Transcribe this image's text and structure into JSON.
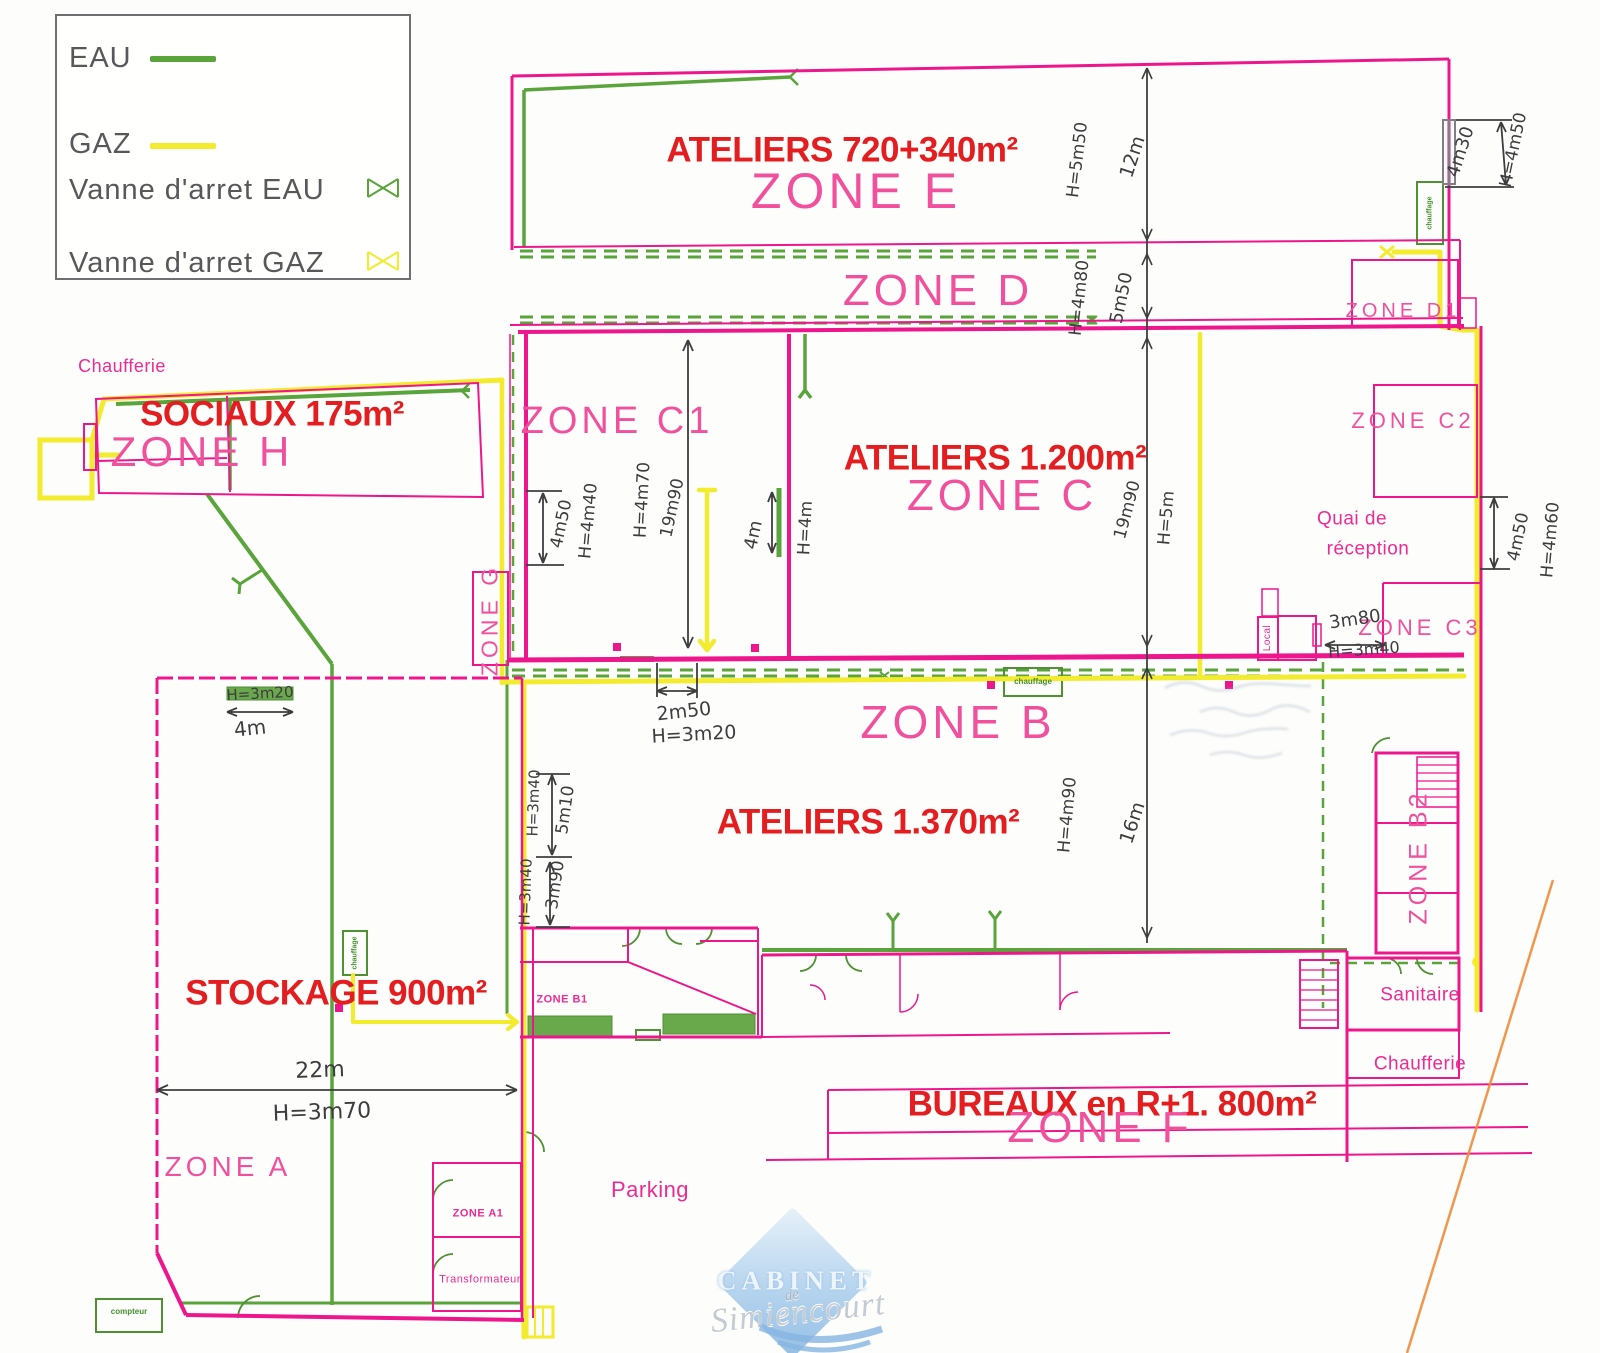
{
  "colors": {
    "wall_pink": "#ee168d",
    "zone_label_pink": "#f0509c",
    "red_area_label": "#e41d20",
    "water_green": "#5aa43c",
    "gas_yellow": "#f3eb2e",
    "dimension_ink": "#3d3d40",
    "boundary_orange": "#ef8b3a",
    "watermark_blue": "#a9cdec"
  },
  "legend": {
    "items": [
      {
        "label": "EAU",
        "symbol": "line",
        "color": "#5aa43c"
      },
      {
        "label": "GAZ",
        "symbol": "line",
        "color": "#f3eb2e"
      },
      {
        "label": "Vanne d'arret EAU",
        "symbol": "valve",
        "color": "#5aa43c"
      },
      {
        "label": "Vanne d'arret GAZ",
        "symbol": "valve",
        "color": "#f3eb2e"
      }
    ]
  },
  "watermark": {
    "line1": "CABINET",
    "line2": "de",
    "line3": "Simiencourt"
  },
  "labels": [
    {
      "name": "area-label-ateliers-720",
      "kind": "red",
      "text": "ATELIERS 720+340m²",
      "x": 842,
      "y": 150,
      "size": 35
    },
    {
      "name": "area-label-sociaux",
      "kind": "red",
      "text": "SOCIAUX 175m²",
      "x": 272,
      "y": 414,
      "size": 35
    },
    {
      "name": "area-label-ateliers-1200",
      "kind": "red",
      "text": "ATELIERS 1.200m²",
      "x": 995,
      "y": 458,
      "size": 35
    },
    {
      "name": "area-label-ateliers-1370",
      "kind": "red",
      "text": "ATELIERS 1.370m²",
      "x": 868,
      "y": 822,
      "size": 35
    },
    {
      "name": "area-label-stockage",
      "kind": "red",
      "text": "STOCKAGE 900m²",
      "x": 336,
      "y": 993,
      "size": 35
    },
    {
      "name": "area-label-bureaux",
      "kind": "red",
      "text": "BUREAUX en R+1. 800m²",
      "x": 1112,
      "y": 1104,
      "size": 35
    },
    {
      "name": "zone-label-e",
      "kind": "zone",
      "text": "ZONE E",
      "x": 856,
      "y": 191,
      "size": 50
    },
    {
      "name": "zone-label-d",
      "kind": "zone",
      "text": "ZONE D",
      "x": 938,
      "y": 291,
      "size": 44
    },
    {
      "name": "zone-label-c1",
      "kind": "zone",
      "text": "ZONE C1",
      "x": 617,
      "y": 421,
      "size": 38
    },
    {
      "name": "zone-label-c",
      "kind": "zone",
      "text": "ZONE C",
      "x": 1002,
      "y": 496,
      "size": 44
    },
    {
      "name": "zone-label-h",
      "kind": "zone",
      "text": "ZONE H",
      "x": 202,
      "y": 452,
      "size": 42
    },
    {
      "name": "zone-label-b",
      "kind": "zone",
      "text": "ZONE B",
      "x": 958,
      "y": 722,
      "size": 46
    },
    {
      "name": "zone-label-f",
      "kind": "zone",
      "text": "ZONE F",
      "x": 1100,
      "y": 1128,
      "size": 44
    },
    {
      "name": "zone-label-a",
      "kind": "zone",
      "text": "ZONE A",
      "x": 228,
      "y": 1167,
      "size": 28
    },
    {
      "name": "zone-label-c2",
      "kind": "zone",
      "text": "ZONE C2",
      "x": 1413,
      "y": 421,
      "size": 22
    },
    {
      "name": "zone-label-d1",
      "kind": "zone",
      "text": "ZONE D1",
      "x": 1403,
      "y": 311,
      "size": 20
    },
    {
      "name": "zone-label-c3",
      "kind": "zone",
      "text": "ZONE C3",
      "x": 1420,
      "y": 628,
      "size": 22
    },
    {
      "name": "zone-label-g",
      "kind": "zone",
      "text": "ZONE G",
      "x": 490,
      "y": 620,
      "size": 23,
      "rot": -90
    },
    {
      "name": "zone-label-b2",
      "kind": "zone",
      "text": "ZONE B2",
      "x": 1419,
      "y": 857,
      "size": 25,
      "rot": -90
    },
    {
      "name": "zone-label-a1",
      "kind": "zone-xs",
      "text": "ZONE A1",
      "x": 478,
      "y": 1214,
      "size": 11
    },
    {
      "name": "zone-label-b1",
      "kind": "zone-xs",
      "text": "ZONE B1",
      "x": 562,
      "y": 1000,
      "size": 11
    },
    {
      "name": "room-label-chaufferie-top",
      "kind": "pink",
      "text": "Chaufferie",
      "x": 122,
      "y": 366,
      "size": 18
    },
    {
      "name": "room-label-quai-1",
      "kind": "pink",
      "text": "Quai de",
      "x": 1352,
      "y": 519,
      "size": 19
    },
    {
      "name": "room-label-quai-2",
      "kind": "pink",
      "text": "réception",
      "x": 1368,
      "y": 549,
      "size": 19
    },
    {
      "name": "room-label-parking",
      "kind": "pink",
      "text": "Parking",
      "x": 650,
      "y": 1190,
      "size": 22
    },
    {
      "name": "room-label-sanitaire",
      "kind": "pink",
      "text": "Sanitaire",
      "x": 1420,
      "y": 995,
      "size": 19
    },
    {
      "name": "room-label-chaufferie-bottom",
      "kind": "pink",
      "text": "Chaufferie",
      "x": 1420,
      "y": 1064,
      "size": 19
    },
    {
      "name": "room-label-local",
      "kind": "pink",
      "text": "Local",
      "x": 1268,
      "y": 638,
      "size": 10,
      "rot": -90
    },
    {
      "name": "room-label-transformateur",
      "kind": "pink",
      "text": "Transformateur",
      "x": 480,
      "y": 1280,
      "size": 11
    },
    {
      "name": "dim-h5m50",
      "kind": "dim",
      "text": "H=5m50",
      "x": 1078,
      "y": 160,
      "rot": -83
    },
    {
      "name": "dim-12m",
      "kind": "dim",
      "text": "12m",
      "x": 1133,
      "y": 157,
      "rot": -72,
      "size": 19
    },
    {
      "name": "dim-h4m80",
      "kind": "dim",
      "text": "H=4m80",
      "x": 1080,
      "y": 298,
      "rot": -84
    },
    {
      "name": "dim-5m50",
      "kind": "dim",
      "text": "5m50",
      "x": 1122,
      "y": 298,
      "rot": -78,
      "size": 18
    },
    {
      "name": "dim-4m30",
      "kind": "dim",
      "text": "4m30",
      "x": 1461,
      "y": 152,
      "rot": -72,
      "size": 18
    },
    {
      "name": "dim-h4m50-top",
      "kind": "dim",
      "text": "H=4m50",
      "x": 1514,
      "y": 150,
      "rot": -78
    },
    {
      "name": "dim-4m50-left",
      "kind": "dim",
      "text": "4m50",
      "x": 562,
      "y": 524,
      "rot": -78
    },
    {
      "name": "dim-h4m40",
      "kind": "dim",
      "text": "H=4m40",
      "x": 589,
      "y": 521,
      "rot": -85
    },
    {
      "name": "dim-h4m70",
      "kind": "dim",
      "text": "H=4m70",
      "x": 643,
      "y": 500,
      "rot": -87
    },
    {
      "name": "dim-19m90-c1",
      "kind": "dim",
      "text": "19m90",
      "x": 673,
      "y": 508,
      "rot": -78
    },
    {
      "name": "dim-4m",
      "kind": "dim",
      "text": "4m",
      "x": 754,
      "y": 535,
      "rot": -78,
      "size": 18
    },
    {
      "name": "dim-h4m",
      "kind": "dim",
      "text": "H=4m",
      "x": 806,
      "y": 528,
      "rot": -87
    },
    {
      "name": "dim-19m90-c",
      "kind": "dim",
      "text": "19m90",
      "x": 1128,
      "y": 510,
      "rot": -75
    },
    {
      "name": "dim-h5m",
      "kind": "dim",
      "text": "H=5m",
      "x": 1167,
      "y": 518,
      "rot": -85
    },
    {
      "name": "dim-4m50-right",
      "kind": "dim",
      "text": "4m50",
      "x": 1519,
      "y": 537,
      "rot": -78
    },
    {
      "name": "dim-h4m60",
      "kind": "dim",
      "text": "H=4m60",
      "x": 1551,
      "y": 540,
      "rot": -85
    },
    {
      "name": "dim-3m80",
      "kind": "dim",
      "text": "3m80",
      "x": 1355,
      "y": 620,
      "rot": -8,
      "size": 18
    },
    {
      "name": "dim-h3m40-c3",
      "kind": "dim",
      "text": "H=3m40",
      "x": 1364,
      "y": 650,
      "rot": -4,
      "size": 16
    },
    {
      "name": "dim-2m50",
      "kind": "dim",
      "text": "2m50",
      "x": 684,
      "y": 712,
      "rot": -6,
      "size": 19
    },
    {
      "name": "dim-h3m20-b",
      "kind": "dim",
      "text": "H=3m20",
      "x": 694,
      "y": 735,
      "rot": -3,
      "size": 19
    },
    {
      "name": "dim-h4m90",
      "kind": "dim",
      "text": "H=4m90",
      "x": 1068,
      "y": 815,
      "rot": -85
    },
    {
      "name": "dim-16m",
      "kind": "dim",
      "text": "16m",
      "x": 1133,
      "y": 823,
      "rot": -72,
      "size": 19
    },
    {
      "name": "dim-h3m40-1",
      "kind": "dim",
      "text": "H=3m40",
      "x": 534,
      "y": 803,
      "rot": -88,
      "size": 15
    },
    {
      "name": "dim-5m10",
      "kind": "dim",
      "text": "5m10",
      "x": 566,
      "y": 810,
      "rot": -82,
      "size": 17
    },
    {
      "name": "dim-h3m40-2",
      "kind": "dim",
      "text": "H=3m40",
      "x": 526,
      "y": 892,
      "rot": -88,
      "size": 15
    },
    {
      "name": "dim-3m90",
      "kind": "dim",
      "text": "3m90",
      "x": 556,
      "y": 885,
      "rot": -82,
      "size": 17
    },
    {
      "name": "dim-h3m20-a",
      "kind": "dim",
      "text": "H=3m20",
      "x": 260,
      "y": 694,
      "rot": -3,
      "size": 15
    },
    {
      "name": "dim-4m-a",
      "kind": "dim",
      "text": "4m",
      "x": 250,
      "y": 728,
      "rot": -6,
      "size": 20
    },
    {
      "name": "dim-22m",
      "kind": "dim",
      "text": "22m",
      "x": 320,
      "y": 1071,
      "rot": -2,
      "size": 22
    },
    {
      "name": "dim-h3m70",
      "kind": "dim",
      "text": "H=3m70",
      "x": 322,
      "y": 1113,
      "rot": -2,
      "size": 22
    },
    {
      "name": "equip-label-chauffage-1",
      "kind": "gtiny",
      "text": "chauffage",
      "x": 1430,
      "y": 213,
      "rot": -90,
      "size": 7
    },
    {
      "name": "equip-label-chauffage-2",
      "kind": "gtiny",
      "text": "chauffage",
      "x": 355,
      "y": 953,
      "rot": -90,
      "size": 7
    },
    {
      "name": "equip-label-chauffage-3",
      "kind": "gtiny",
      "text": "chauffage",
      "x": 1033,
      "y": 682,
      "rot": 0,
      "size": 8
    },
    {
      "name": "equip-label-compteur",
      "kind": "gtiny",
      "text": "compteur",
      "x": 129,
      "y": 1312,
      "rot": 0,
      "size": 8
    }
  ]
}
